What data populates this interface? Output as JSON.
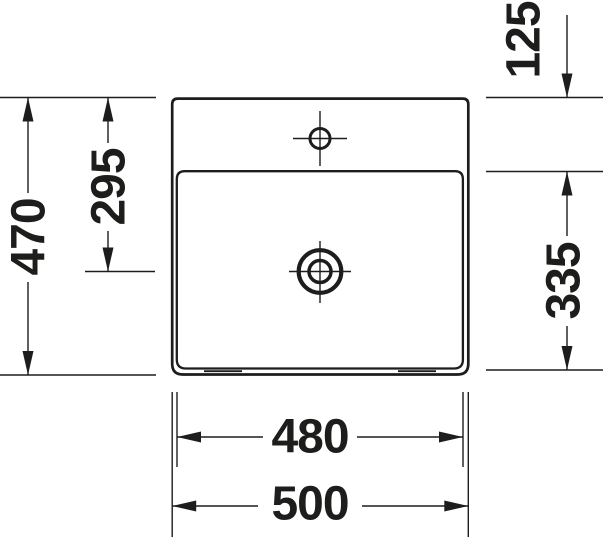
{
  "drawing": {
    "background_color": "#ffffff",
    "line_color": "#1d1d1b",
    "dims": {
      "overall_depth": "470",
      "back_edge_to_drain": "295",
      "back_edge_to_bowl": "125",
      "bowl_depth": "335",
      "bowl_width": "480",
      "overall_width": "500"
    }
  }
}
